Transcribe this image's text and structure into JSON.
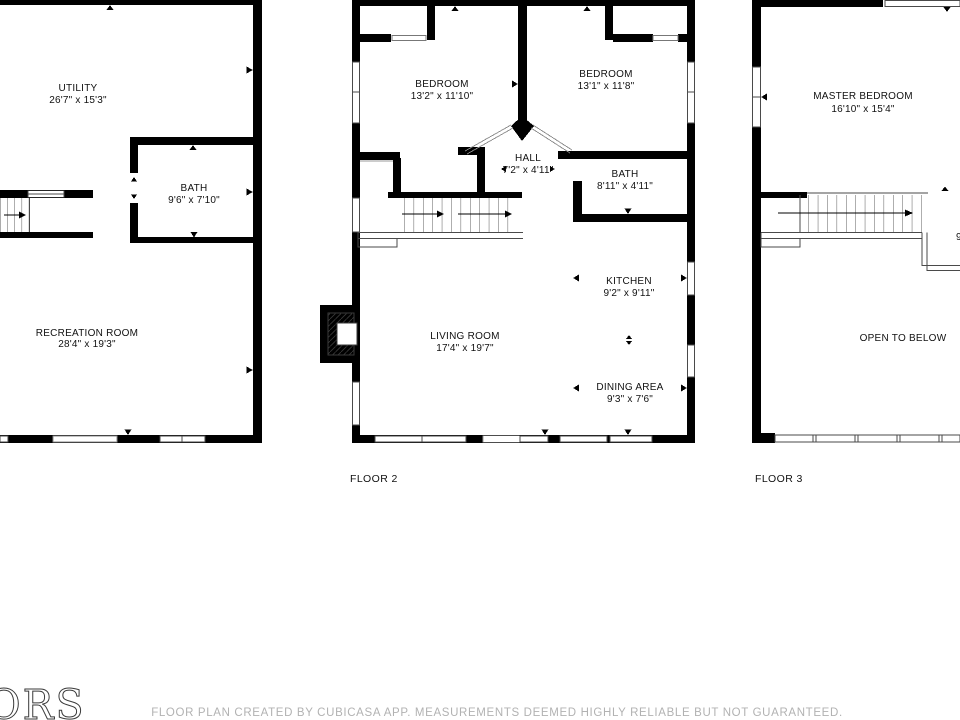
{
  "page": {
    "background": "#ffffff",
    "wall_color": "#000000",
    "footer_gray": "#b2b2b2"
  },
  "floor1": {
    "rooms": {
      "utility": {
        "name": "UTILITY",
        "dims": "26'7\" x 15'3\""
      },
      "bath": {
        "name": "BATH",
        "dims": "9'6\" x 7'10\""
      },
      "recreation": {
        "name": "RECREATION ROOM",
        "dims": "28'4\" x 19'3\""
      }
    }
  },
  "floor2": {
    "label": "FLOOR 2",
    "rooms": {
      "bedroom1": {
        "name": "BEDROOM",
        "dims": "13'2\" x 11'10\""
      },
      "bedroom2": {
        "name": "BEDROOM",
        "dims": "13'1\" x 11'8\""
      },
      "hall": {
        "name": "HALL",
        "dims": "7'2\" x 4'11\""
      },
      "bath": {
        "name": "BATH",
        "dims": "8'11\" x 4'11\""
      },
      "kitchen": {
        "name": "KITCHEN",
        "dims": "9'2\" x 9'11\""
      },
      "living": {
        "name": "LIVING ROOM",
        "dims": "17'4\" x 19'7\""
      },
      "dining": {
        "name": "DINING AREA",
        "dims": "9'3\" x 7'6\""
      }
    }
  },
  "floor3": {
    "label": "FLOOR 3",
    "rooms": {
      "master": {
        "name": "MASTER BEDROOM",
        "dims": "16'10\" x 15'4\""
      },
      "open": {
        "name": "OPEN TO BELOW"
      }
    },
    "clipped_dimension": "9"
  },
  "footer": {
    "disclaimer": "FLOOR PLAN CREATED BY CUBICASA APP. MEASUREMENTS DEEMED HIGHLY RELIABLE BUT NOT GUARANTEED."
  },
  "logo": {
    "text": "ORS"
  }
}
